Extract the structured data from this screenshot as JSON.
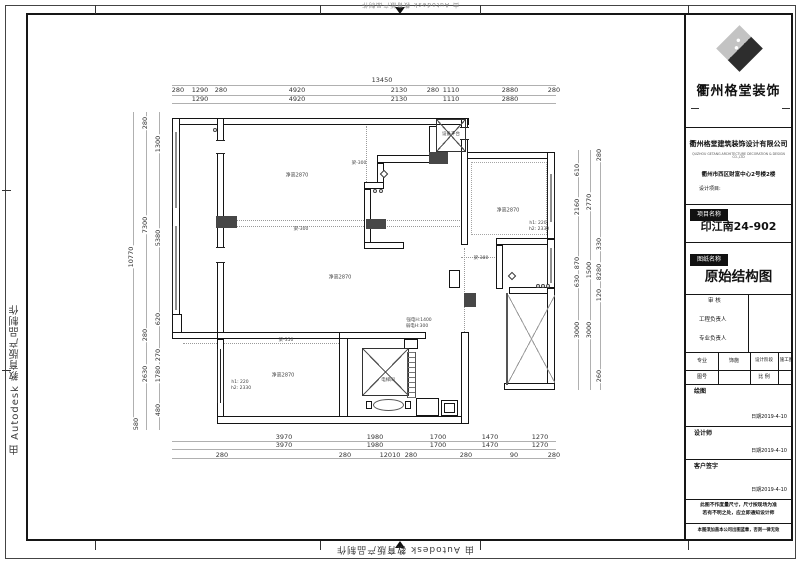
{
  "watermark": {
    "text": "由 Autodesk 教育版产品制作"
  },
  "title_block": {
    "brand": "衢州格堂装饰",
    "company": "衢州格堂建筑装饰设计有限公司",
    "company_en": "QUZHOU GETANG ARCHITECTURE DECORATION & DESIGN CO.,LTD",
    "address": "衢州市西区财富中心2号楼2楼",
    "design_project_label": "设计项目:",
    "project_name_label": "项目名称",
    "project_name": "印江南24-902",
    "drawing_name_label": "图纸名称",
    "drawing_name": "原始结构图",
    "review_label": "审  核",
    "pm_label": "工程负责人",
    "pro_label": "专业负责人",
    "spec_label": "专业",
    "spec_value": "饰施",
    "stage_label": "设计阶段",
    "stage_value": "施工图",
    "fig_no_label": "图号",
    "scale_label": "比 例",
    "draw_label": "绘图",
    "designer_label": "设计师",
    "client_label": "客户签字",
    "date": "日期2019-4-10",
    "note1a": "此图不作度量尺寸，尺寸按现场为准",
    "note1b": "若有不明之处，应立即通知设计师",
    "note2": "本图须加盖本公司出图蓝章，否则一律无效"
  },
  "plan": {
    "labels": [
      {
        "t": "13450",
        "x": 382,
        "y": 80,
        "c": "dim"
      },
      {
        "t": "280",
        "x": 178,
        "y": 90,
        "c": "dim"
      },
      {
        "t": "1290",
        "x": 200,
        "y": 90,
        "c": "dim"
      },
      {
        "t": "280",
        "x": 221,
        "y": 90,
        "c": "dim"
      },
      {
        "t": "4920",
        "x": 297,
        "y": 90,
        "c": "dim"
      },
      {
        "t": "2130",
        "x": 399,
        "y": 90,
        "c": "dim"
      },
      {
        "t": "280",
        "x": 433,
        "y": 90,
        "c": "dim"
      },
      {
        "t": "1110",
        "x": 451,
        "y": 90,
        "c": "dim"
      },
      {
        "t": "2880",
        "x": 510,
        "y": 90,
        "c": "dim"
      },
      {
        "t": "280",
        "x": 554,
        "y": 90,
        "c": "dim"
      },
      {
        "t": "1290",
        "x": 200,
        "y": 99,
        "c": "dim"
      },
      {
        "t": "4920",
        "x": 297,
        "y": 99,
        "c": "dim"
      },
      {
        "t": "2130",
        "x": 399,
        "y": 99,
        "c": "dim"
      },
      {
        "t": "1110",
        "x": 451,
        "y": 99,
        "c": "dim"
      },
      {
        "t": "2880",
        "x": 510,
        "y": 99,
        "c": "dim"
      },
      {
        "t": "3970",
        "x": 284,
        "y": 437,
        "c": "dim"
      },
      {
        "t": "1980",
        "x": 375,
        "y": 437,
        "c": "dim"
      },
      {
        "t": "1700",
        "x": 438,
        "y": 437,
        "c": "dim"
      },
      {
        "t": "1470",
        "x": 490,
        "y": 437,
        "c": "dim"
      },
      {
        "t": "1270",
        "x": 540,
        "y": 437,
        "c": "dim"
      },
      {
        "t": "3970",
        "x": 284,
        "y": 445,
        "c": "dim"
      },
      {
        "t": "1980",
        "x": 375,
        "y": 445,
        "c": "dim"
      },
      {
        "t": "1700",
        "x": 438,
        "y": 445,
        "c": "dim"
      },
      {
        "t": "1470",
        "x": 490,
        "y": 445,
        "c": "dim"
      },
      {
        "t": "1270",
        "x": 540,
        "y": 445,
        "c": "dim"
      },
      {
        "t": "280",
        "x": 222,
        "y": 455,
        "c": "dim"
      },
      {
        "t": "280",
        "x": 345,
        "y": 455,
        "c": "dim"
      },
      {
        "t": "12010",
        "x": 390,
        "y": 455,
        "c": "dim"
      },
      {
        "t": "280",
        "x": 411,
        "y": 455,
        "c": "dim"
      },
      {
        "t": "280",
        "x": 466,
        "y": 455,
        "c": "dim"
      },
      {
        "t": "90",
        "x": 514,
        "y": 455,
        "c": "dim"
      },
      {
        "t": "280",
        "x": 554,
        "y": 455,
        "c": "dim"
      },
      {
        "t": "10770",
        "x": 131,
        "y": 257,
        "c": "dimv"
      },
      {
        "t": "280",
        "x": 145,
        "y": 123,
        "c": "dimv"
      },
      {
        "t": "7300",
        "x": 145,
        "y": 225,
        "c": "dimv"
      },
      {
        "t": "280",
        "x": 145,
        "y": 335,
        "c": "dimv"
      },
      {
        "t": "2630",
        "x": 145,
        "y": 374,
        "c": "dimv"
      },
      {
        "t": "580",
        "x": 136,
        "y": 424,
        "c": "dimv"
      },
      {
        "t": "1300",
        "x": 158,
        "y": 144,
        "c": "dimv"
      },
      {
        "t": "5380",
        "x": 158,
        "y": 238,
        "c": "dimv"
      },
      {
        "t": "620",
        "x": 158,
        "y": 319,
        "c": "dimv"
      },
      {
        "t": "270",
        "x": 158,
        "y": 355,
        "c": "dimv"
      },
      {
        "t": "1780",
        "x": 158,
        "y": 374,
        "c": "dimv"
      },
      {
        "t": "480",
        "x": 158,
        "y": 410,
        "c": "dimv"
      },
      {
        "t": "280",
        "x": 599,
        "y": 155,
        "c": "dimv"
      },
      {
        "t": "610",
        "x": 577,
        "y": 170,
        "c": "dimv"
      },
      {
        "t": "2770",
        "x": 589,
        "y": 202,
        "c": "dimv"
      },
      {
        "t": "2160",
        "x": 577,
        "y": 207,
        "c": "dimv"
      },
      {
        "t": "330",
        "x": 599,
        "y": 244,
        "c": "dimv"
      },
      {
        "t": "870",
        "x": 577,
        "y": 263,
        "c": "dimv"
      },
      {
        "t": "1500",
        "x": 589,
        "y": 270,
        "c": "dimv"
      },
      {
        "t": "8280",
        "x": 599,
        "y": 272,
        "c": "dimv"
      },
      {
        "t": "630",
        "x": 577,
        "y": 281,
        "c": "dimv"
      },
      {
        "t": "120",
        "x": 599,
        "y": 295,
        "c": "dimv"
      },
      {
        "t": "3000",
        "x": 577,
        "y": 330,
        "c": "dimv"
      },
      {
        "t": "3000",
        "x": 589,
        "y": 330,
        "c": "dimv"
      },
      {
        "t": "260",
        "x": 599,
        "y": 376,
        "c": "dimv"
      },
      {
        "t": "设备平台",
        "x": 451,
        "y": 135,
        "c": "tiny"
      },
      {
        "t": "电梯间",
        "x": 388,
        "y": 381,
        "c": "tiny"
      },
      {
        "t": "净高2870",
        "x": 297,
        "y": 176,
        "c": "room"
      },
      {
        "t": "净高2870",
        "x": 340,
        "y": 278,
        "c": "room"
      },
      {
        "t": "净高2870",
        "x": 283,
        "y": 376,
        "c": "room"
      },
      {
        "t": "净高2870",
        "x": 508,
        "y": 211,
        "c": "room"
      },
      {
        "t": "梁-300",
        "x": 301,
        "y": 230,
        "c": "tiny"
      },
      {
        "t": "梁-300",
        "x": 359,
        "y": 164,
        "c": "tiny"
      },
      {
        "t": "梁-350",
        "x": 286,
        "y": 341,
        "c": "tiny"
      },
      {
        "t": "梁-380",
        "x": 481,
        "y": 259,
        "c": "tiny"
      },
      {
        "t": "强电H:1400",
        "x": 419,
        "y": 321,
        "c": "tiny"
      },
      {
        "t": "弱电H:300",
        "x": 417,
        "y": 327,
        "c": "tiny"
      },
      {
        "t": "h1: 220",
        "x": 240,
        "y": 383,
        "c": "tiny"
      },
      {
        "t": "h2: 2330",
        "x": 241,
        "y": 389,
        "c": "tiny"
      },
      {
        "t": "h1: 220",
        "x": 538,
        "y": 224,
        "c": "tiny"
      },
      {
        "t": "h2: 2330",
        "x": 539,
        "y": 230,
        "c": "tiny"
      }
    ]
  }
}
